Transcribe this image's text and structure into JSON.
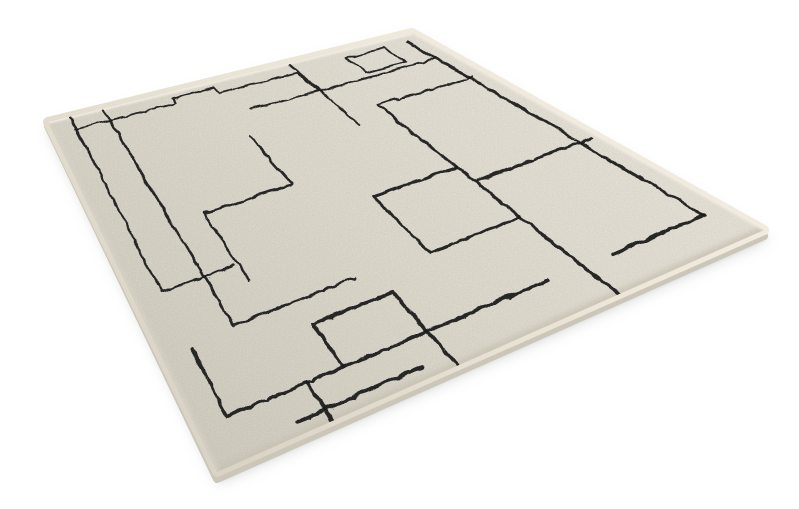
{
  "scene": {
    "description": "Angled product photo of an ivory area rug with a black hand-drawn abstract rectilinear line pattern on a plain white background",
    "background_color": "#ffffff",
    "rug": {
      "surface_color_light": "#f0ebde",
      "surface_color_mid": "#e7e2d4",
      "surface_color_dark": "#d8d3c5",
      "pattern_line_color": "#1a1a1b",
      "side_color": "#cbc6b8",
      "side_edge_color": "#b6b1a3",
      "shadow_soft_color": "#b9b9b7",
      "shadow_contact_color": "#8e8a81",
      "highlight_color": "#f6f2e8",
      "corners": {
        "west": [
          48,
          122
        ],
        "north": [
          412,
          33
        ],
        "east": [
          764,
          230
        ],
        "south": [
          217,
          472
        ]
      },
      "pattern_polylines": [
        [
          [
            0.055,
            0.032
          ],
          [
            0.33,
            0.032
          ],
          [
            0.33,
            0.014
          ],
          [
            0.445,
            0.014
          ],
          [
            0.445,
            0.032
          ],
          [
            0.655,
            0.032
          ],
          [
            0.655,
            0.105
          ]
        ],
        [
          [
            0.48,
            0.105
          ],
          [
            0.965,
            0.105
          ]
        ],
        [
          [
            0.795,
            0.025
          ],
          [
            0.9,
            0.025
          ],
          [
            0.9,
            0.088
          ],
          [
            0.795,
            0.088
          ],
          [
            0.795,
            0.025
          ]
        ],
        [
          [
            0.965,
            0.02
          ],
          [
            0.965,
            0.88
          ]
        ],
        [
          [
            0.058,
            0.0
          ],
          [
            0.058,
            0.51
          ],
          [
            0.215,
            0.51
          ]
        ],
        [
          [
            0.15,
            0.0
          ],
          [
            0.15,
            0.66
          ],
          [
            0.4,
            0.66
          ]
        ],
        [
          [
            0.66,
            0.0
          ],
          [
            0.66,
            0.24
          ]
        ],
        [
          [
            0.43,
            0.18
          ],
          [
            0.43,
            0.35
          ],
          [
            0.225,
            0.35
          ],
          [
            0.225,
            0.56
          ]
        ],
        [
          [
            0.55,
            0.46
          ],
          [
            0.735,
            0.46
          ],
          [
            0.735,
            0.67
          ],
          [
            0.55,
            0.67
          ],
          [
            0.55,
            0.46
          ]
        ],
        [
          [
            0.735,
            0.67
          ],
          [
            0.735,
            1.0
          ]
        ],
        [
          [
            0.735,
            0.2
          ],
          [
            0.735,
            0.46
          ]
        ],
        [
          [
            0.058,
            0.68
          ],
          [
            0.058,
            0.875
          ],
          [
            0.67,
            0.875
          ]
        ],
        [
          [
            0.28,
            0.875
          ],
          [
            0.28,
            0.735
          ],
          [
            0.44,
            0.735
          ],
          [
            0.44,
            0.875
          ]
        ],
        [
          [
            0.44,
            0.875
          ],
          [
            0.44,
            1.0
          ]
        ],
        [
          [
            0.74,
            0.52
          ],
          [
            0.99,
            0.52
          ]
        ],
        [
          [
            0.16,
            0.96
          ],
          [
            0.39,
            0.96
          ]
        ],
        [
          [
            0.79,
            0.88
          ],
          [
            0.965,
            0.88
          ]
        ],
        [
          [
            0.735,
            0.2
          ],
          [
            0.97,
            0.2
          ]
        ],
        [
          [
            0.21,
            0.875
          ],
          [
            0.21,
            1.0
          ]
        ]
      ]
    }
  }
}
